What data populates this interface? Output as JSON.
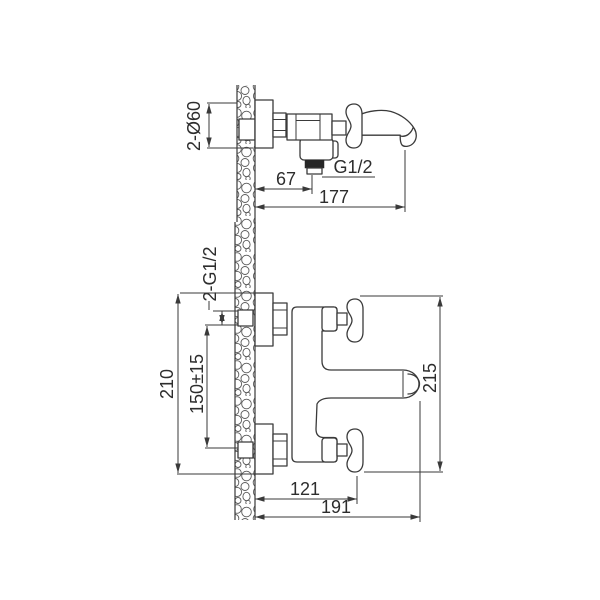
{
  "page": {
    "background": "#ffffff",
    "line_color": "#3a3a3a",
    "text_color": "#2d2d2d",
    "description": "Technical dimension drawing of a wall-mounted bath mixer faucet shown in two orthographic views"
  },
  "side_view": {
    "title": "side view",
    "dim_escutcheon_diameter": "2-Ø60",
    "dim_outlet_offset": "67",
    "dim_outlet_thread": "G1/2",
    "dim_overall_depth": "177"
  },
  "plan_view": {
    "title": "plan view",
    "dim_inlet_thread": "2-G1/2",
    "dim_overall_width": "210",
    "dim_inlet_centers": "150±15",
    "dim_overall_span": "215",
    "dim_handle_depth": "121",
    "dim_overall_depth": "191"
  }
}
